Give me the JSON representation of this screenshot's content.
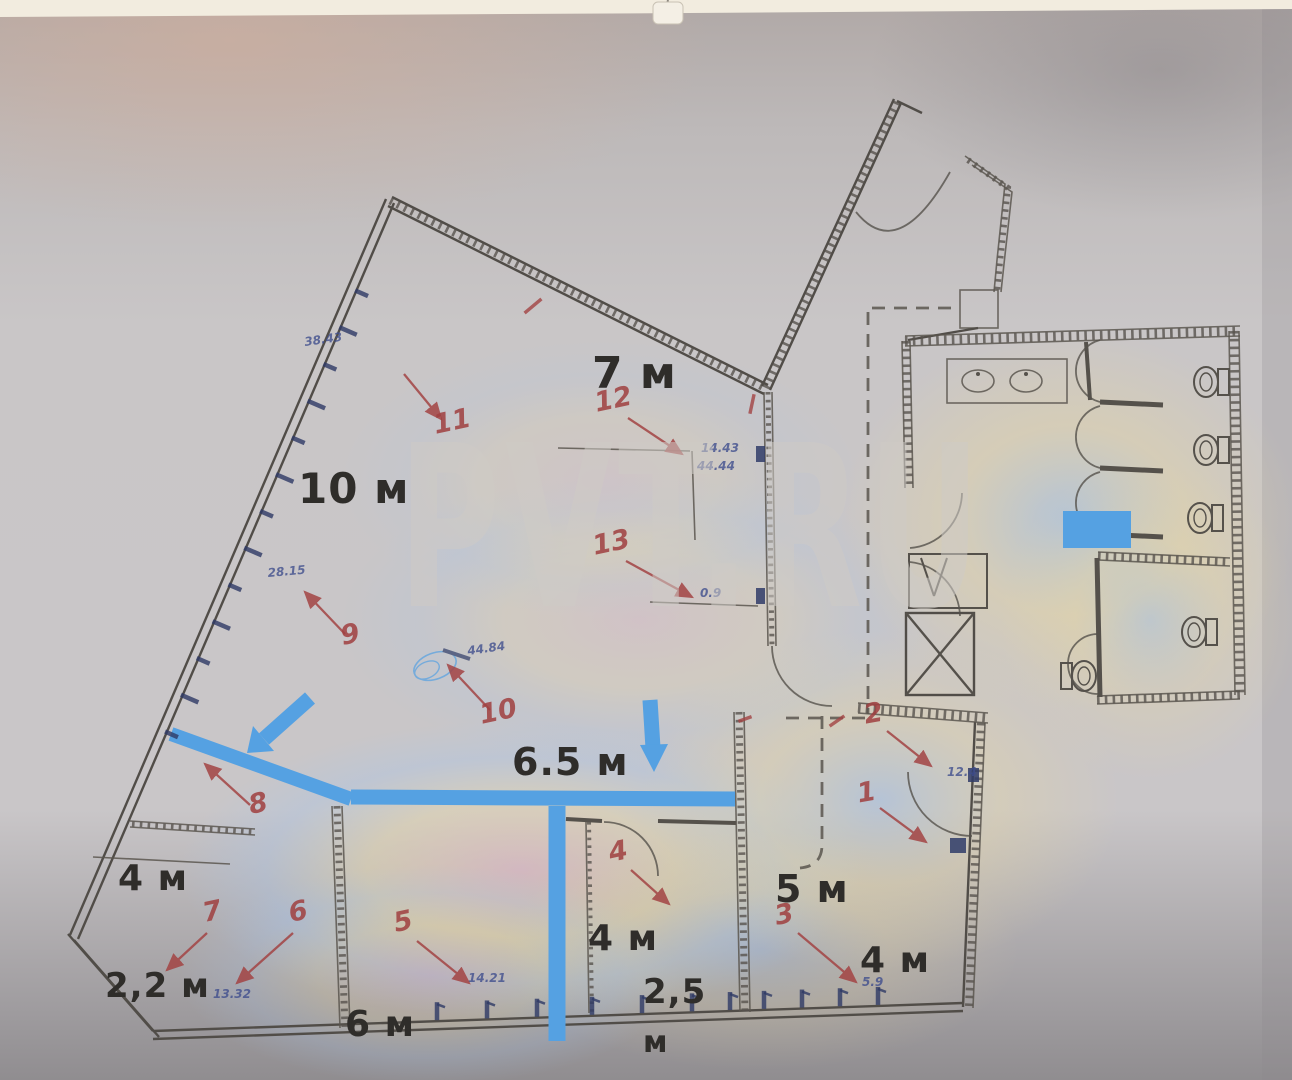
{
  "watermark": "PVT.RU",
  "plan": {
    "room_labels": [
      {
        "id": "hall-10",
        "t": "10 м",
        "x": 298,
        "y": 503,
        "s": 42
      },
      {
        "id": "hall-7",
        "t": "7 м",
        "x": 592,
        "y": 388,
        "s": 44
      },
      {
        "id": "corridor-65",
        "t": "6.5 м",
        "x": 512,
        "y": 775,
        "s": 38
      },
      {
        "id": "left-4",
        "t": "4 м",
        "x": 118,
        "y": 890,
        "s": 36
      },
      {
        "id": "left-22",
        "t": "2,2 м",
        "x": 105,
        "y": 997,
        "s": 34
      },
      {
        "id": "bottom-6",
        "t": "6 м",
        "x": 345,
        "y": 1036,
        "s": 36
      },
      {
        "id": "center-4",
        "t": "4 м",
        "x": 588,
        "y": 950,
        "s": 36
      },
      {
        "id": "center-25",
        "t": "2,5",
        "x": 643,
        "y": 1003,
        "s": 34
      },
      {
        "id": "center-m",
        "t": "м",
        "x": 643,
        "y": 1052,
        "s": 30
      },
      {
        "id": "right-5",
        "t": "5 м",
        "x": 775,
        "y": 902,
        "s": 38
      },
      {
        "id": "right-4",
        "t": "4 м",
        "x": 860,
        "y": 972,
        "s": 36
      }
    ],
    "annotations": [
      {
        "n": "1",
        "lx": 868,
        "ly": 801,
        "rot": -10,
        "x1": 880,
        "y1": 808,
        "x2": 926,
        "y2": 842
      },
      {
        "n": "2",
        "lx": 875,
        "ly": 722,
        "rot": -10,
        "x1": 887,
        "y1": 731,
        "x2": 931,
        "y2": 766
      },
      {
        "n": "3",
        "lx": 786,
        "ly": 923,
        "rot": -12,
        "x1": 798,
        "y1": 933,
        "x2": 856,
        "y2": 982
      },
      {
        "n": "4",
        "lx": 620,
        "ly": 860,
        "rot": -12,
        "x1": 631,
        "y1": 870,
        "x2": 669,
        "y2": 904
      },
      {
        "n": "5",
        "lx": 405,
        "ly": 930,
        "rot": -12,
        "x1": 417,
        "y1": 941,
        "x2": 469,
        "y2": 983
      },
      {
        "n": "6",
        "lx": 300,
        "ly": 920,
        "rot": -12,
        "x1": 293,
        "y1": 933,
        "x2": 237,
        "y2": 983
      },
      {
        "n": "7",
        "lx": 214,
        "ly": 920,
        "rot": -12,
        "x1": 207,
        "y1": 933,
        "x2": 167,
        "y2": 970
      },
      {
        "n": "8",
        "lx": 260,
        "ly": 812,
        "rot": -12,
        "x1": 250,
        "y1": 805,
        "x2": 205,
        "y2": 764
      },
      {
        "n": "9",
        "lx": 352,
        "ly": 643,
        "rot": -12,
        "x1": 345,
        "y1": 634,
        "x2": 305,
        "y2": 592
      },
      {
        "n": "10",
        "lx": 500,
        "ly": 720,
        "rot": -12,
        "x1": 490,
        "y1": 710,
        "x2": 448,
        "y2": 665
      },
      {
        "n": "11",
        "lx": 454,
        "ly": 430,
        "rot": -12,
        "x1": 404,
        "y1": 374,
        "x2": 441,
        "y2": 419
      },
      {
        "n": "12",
        "lx": 615,
        "ly": 408,
        "rot": -12,
        "x1": 628,
        "y1": 418,
        "x2": 682,
        "y2": 454
      },
      {
        "n": "13",
        "lx": 613,
        "ly": 551,
        "rot": -12,
        "x1": 626,
        "y1": 561,
        "x2": 692,
        "y2": 597
      }
    ],
    "dims": [
      {
        "t": "38.43",
        "x": 305,
        "y": 346,
        "r": -8
      },
      {
        "t": "28.15",
        "x": 268,
        "y": 577,
        "r": -5
      },
      {
        "t": "44.84",
        "x": 468,
        "y": 655,
        "r": -8
      },
      {
        "t": "14.43",
        "x": 701,
        "y": 452,
        "r": 0
      },
      {
        "t": "44.44",
        "x": 697,
        "y": 470,
        "r": 0
      },
      {
        "t": "0.9",
        "x": 700,
        "y": 597,
        "r": 0
      },
      {
        "t": "12.4",
        "x": 947,
        "y": 776,
        "r": 0
      },
      {
        "t": "5.9",
        "x": 862,
        "y": 986,
        "r": 0
      },
      {
        "t": "14.21",
        "x": 468,
        "y": 982,
        "r": 0
      },
      {
        "t": "13.32",
        "x": 213,
        "y": 998,
        "r": 0
      }
    ],
    "red_ticks": [
      {
        "x": 533,
        "y": 306,
        "a": -40,
        "l": 22
      },
      {
        "x": 752,
        "y": 404,
        "a": -78,
        "l": 20
      },
      {
        "x": 837,
        "y": 721,
        "a": -35,
        "l": 18
      },
      {
        "x": 745,
        "y": 719,
        "a": -20,
        "l": 14
      }
    ]
  }
}
